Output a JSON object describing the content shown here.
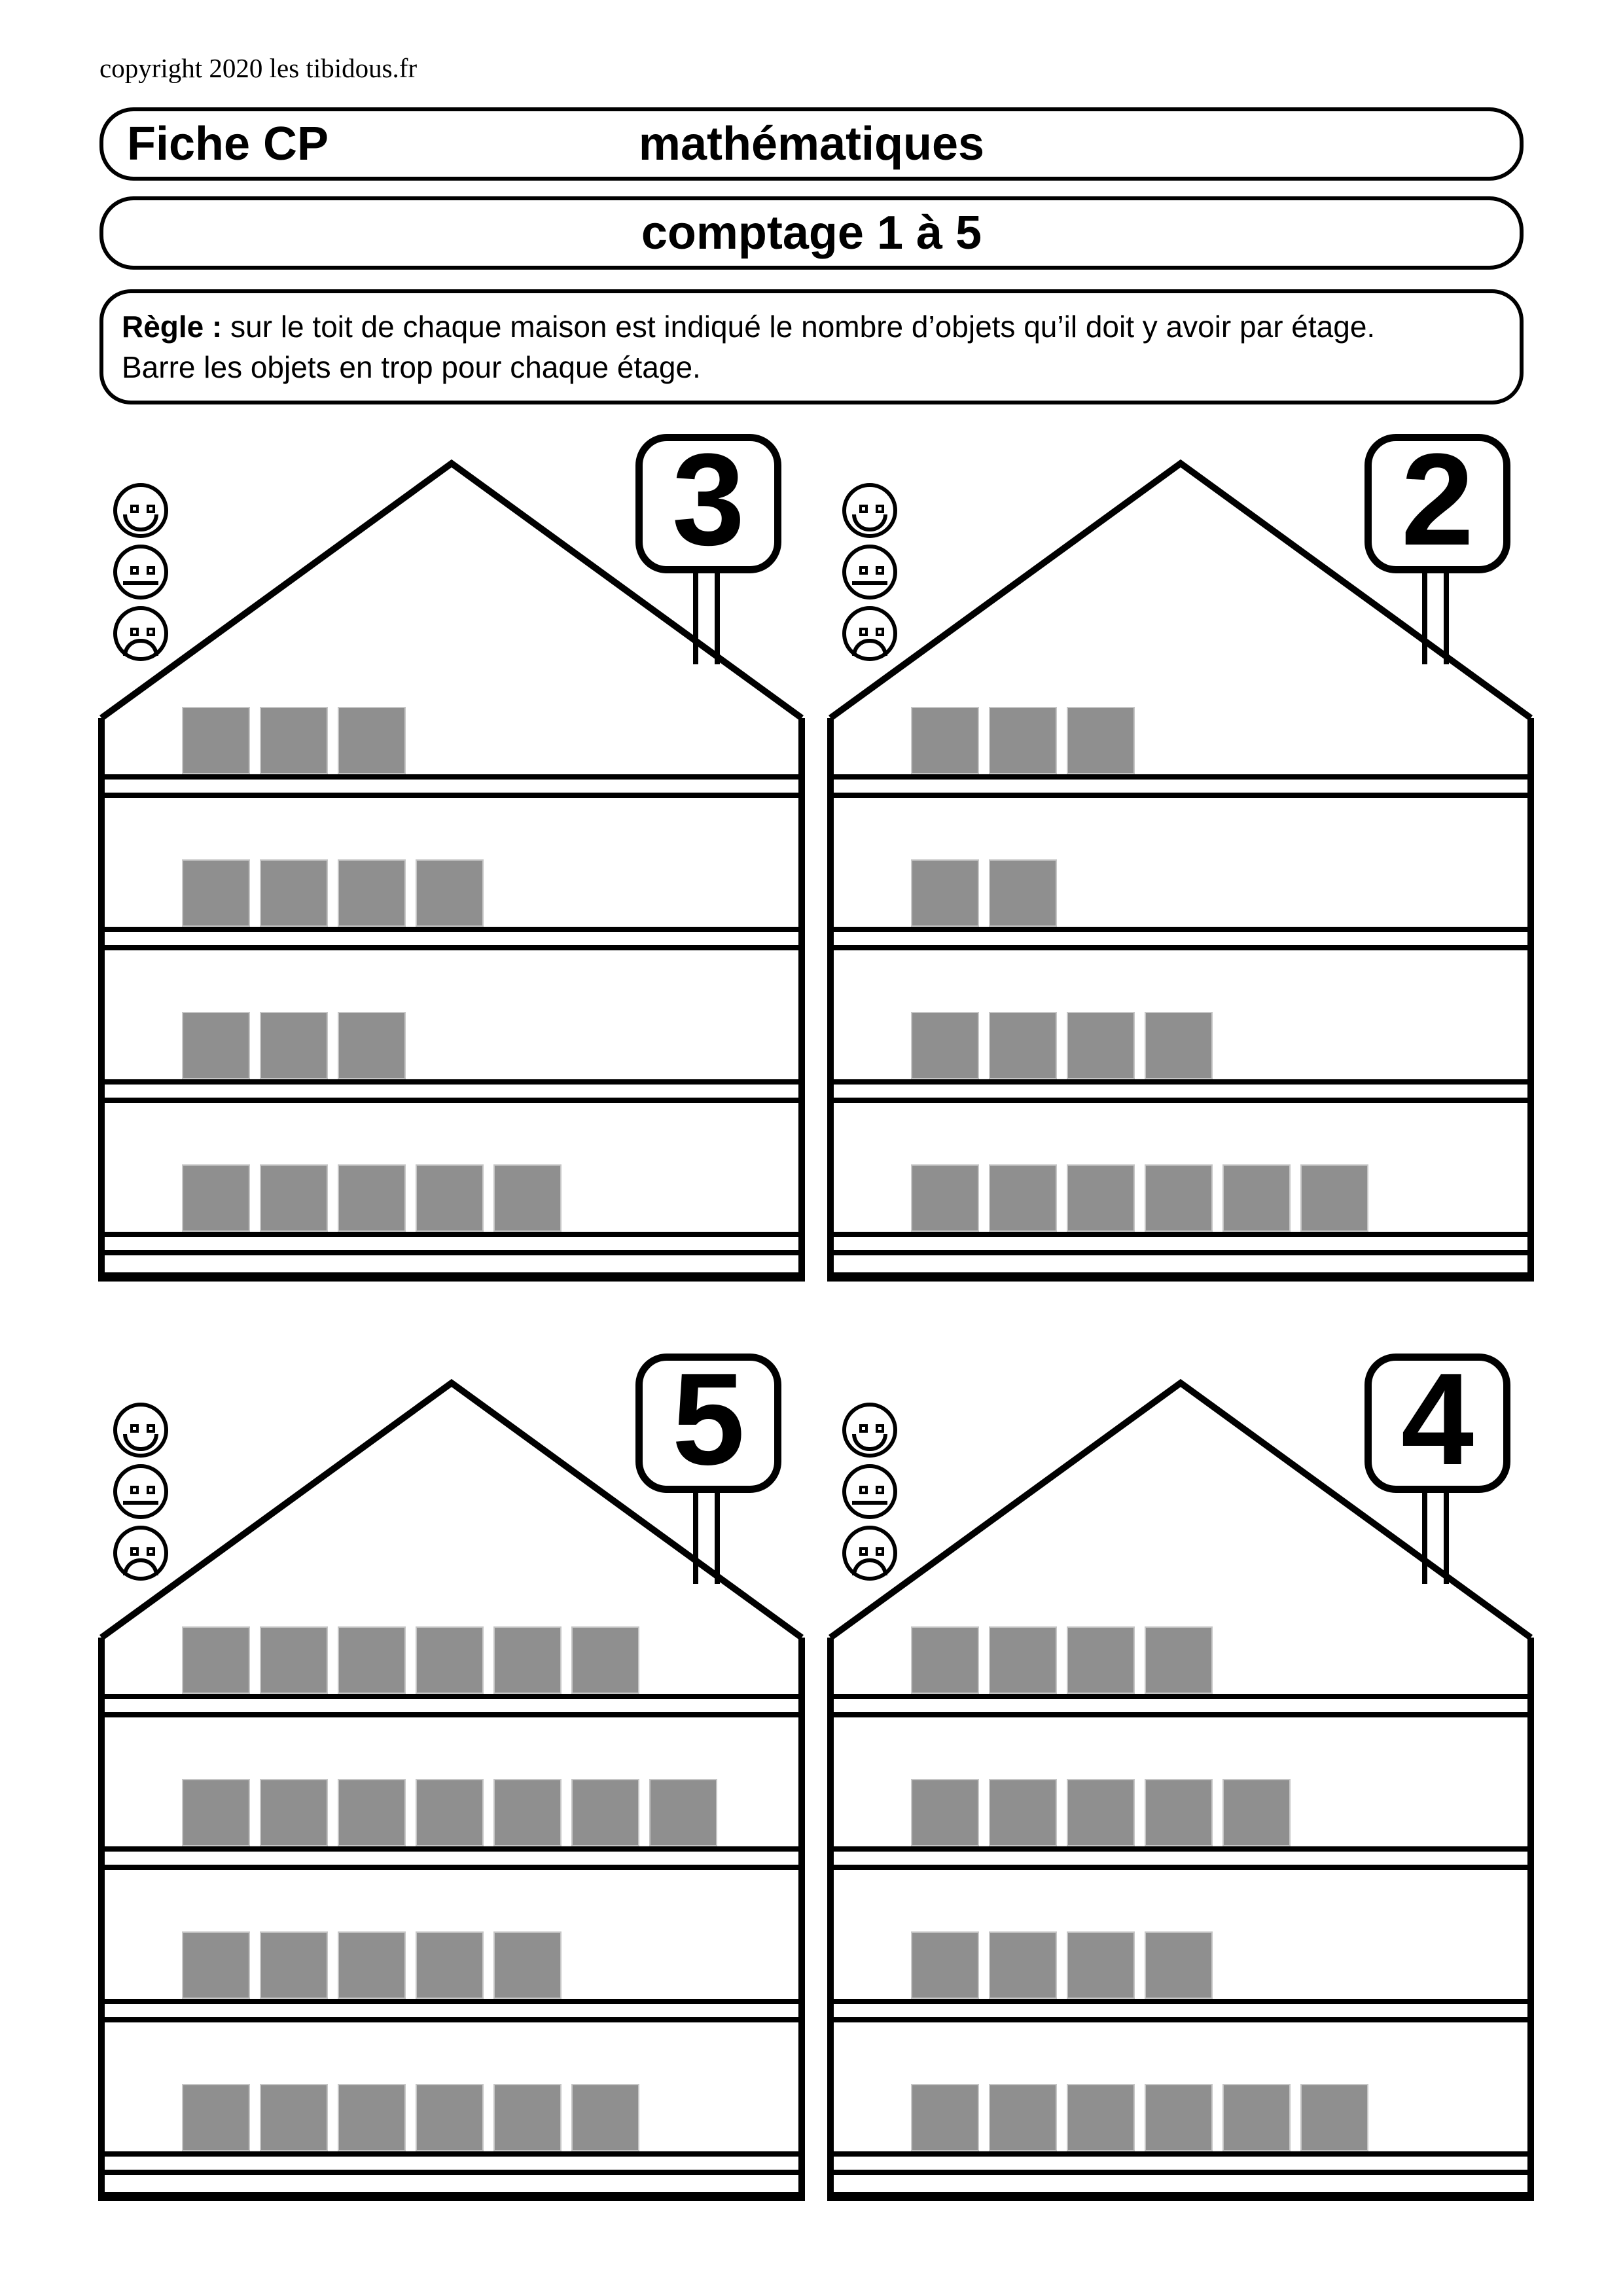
{
  "page": {
    "copyright": "copyright 2020 les tibidous.fr",
    "sheet_label": "Fiche CP",
    "subject": "mathématiques",
    "title": "comptage 1 à 5"
  },
  "rule": {
    "label": "Règle :",
    "line1": "sur le toit de chaque maison est indiqué le nombre d’objets qu’il doit y avoir par étage.",
    "line2": "Barre les objets en trop pour chaque étage."
  },
  "colors": {
    "line": "#000000",
    "object_square": "#8f8f8f",
    "background": "#ffffff"
  },
  "rating_icons": [
    "happy-face-icon",
    "neutral-face-icon",
    "sad-face-icon"
  ],
  "houses": [
    {
      "sign_number": "3",
      "floors_object_counts": [
        3,
        4,
        3,
        5
      ]
    },
    {
      "sign_number": "2",
      "floors_object_counts": [
        3,
        2,
        4,
        6
      ]
    },
    {
      "sign_number": "5",
      "floors_object_counts": [
        6,
        7,
        5,
        6
      ]
    },
    {
      "sign_number": "4",
      "floors_object_counts": [
        4,
        5,
        4,
        6
      ]
    }
  ]
}
